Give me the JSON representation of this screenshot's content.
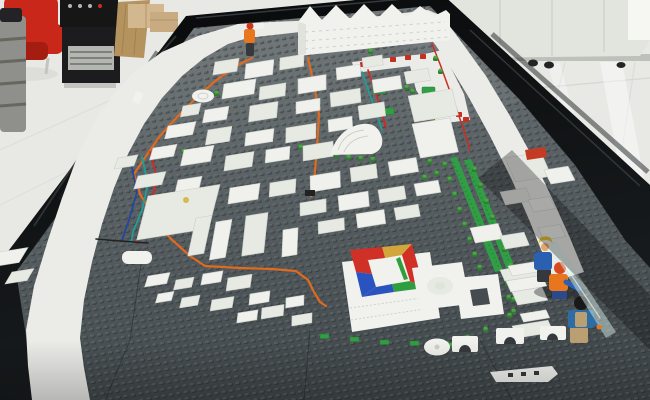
{
  "scene": {
    "type": "photograph",
    "subject": "lego-city-architectural-model-on-black-table"
  },
  "palette": {
    "floor": "#e8e9e5",
    "floorSeam": "#d5d7d1",
    "gloss": "#ffffff",
    "cabinet": "#e2e4de",
    "cabinetSeam": "#c6cac2",
    "cabinetShadow": "#b2b6ae",
    "brightPanel": "#f6f7f3",
    "chairRed": "#c8271a",
    "chairRedDark": "#a51d10",
    "grayStack": "#8f8f8b",
    "grayStripe": "#67675f",
    "darkCap": "#232325",
    "ampBlack": "#161616",
    "boxBlack": "#1c1c1e",
    "grille": "#b4b6b2",
    "grilleSlot": "#4a4c48",
    "metal": "#c2c4c0",
    "wood": "#b5935f",
    "woodGrain": "#997a49",
    "cardboard": "#d3b78e",
    "cardboardDark": "#c8ab80",
    "cardboardEdge": "#b0946a",
    "rim": "#0b0d0e",
    "rimGloss": "#343a3c",
    "rimGloss2": "#1d2224",
    "baseFar": "#7b8181",
    "baseNear": "#454b4e",
    "seam": "#262b2e",
    "road": "#ebece8",
    "roadEdge": "#d9dbd4",
    "building": "#f0f1ed",
    "buildingAlt": "#e7e9e3",
    "buildingEdge": "#cdd1ca",
    "buildingShade": "#e0e2dc",
    "green": "#4aa840",
    "greenDark": "#2e7d32",
    "greenStrip": "#2f9e44",
    "red": "#c62f22",
    "yellowDot": "#d8b84a",
    "wireOrange": "#e06a1e",
    "wireRed": "#cf2b20",
    "wireTeal": "#1f9e96",
    "wireBlue": "#23479e",
    "wireDark": "#222222",
    "ringRed": "#d03026",
    "ringYellow": "#d2a63a",
    "ringBlue": "#2b53c0",
    "ringGreen": "#2f9e3f",
    "figOrange": "#e8761e",
    "figOrangeRed": "#d84a1e",
    "figBlue": "#2b5fb0",
    "figNavy": "#2b4a8e",
    "figJacket": "#2e6da4",
    "figTan": "#b99f72",
    "figDark": "#35393d",
    "figYellow": "#e6c22e",
    "figSkin": "#e0a86a",
    "hairBlack": "#191919",
    "helmetRed": "#c23b22",
    "glass": "#d4ece6",
    "glassEdge": "#eaf6f2",
    "white": "#f1f2ee",
    "shadow": "#05080a"
  },
  "city": {
    "buildings": [
      [
        215,
        62,
        24,
        13
      ],
      [
        246,
        64,
        28,
        15
      ],
      [
        280,
        58,
        24,
        12
      ],
      [
        336,
        68,
        24,
        12
      ],
      [
        362,
        58,
        20,
        10
      ],
      [
        372,
        80,
        28,
        13
      ],
      [
        404,
        72,
        24,
        12
      ],
      [
        224,
        84,
        32,
        15
      ],
      [
        260,
        87,
        26,
        13
      ],
      [
        298,
        79,
        28,
        15
      ],
      [
        330,
        93,
        30,
        14
      ],
      [
        296,
        102,
        24,
        12
      ],
      [
        250,
        106,
        28,
        16
      ],
      [
        205,
        110,
        24,
        13
      ],
      [
        183,
        106,
        18,
        11
      ],
      [
        168,
        126,
        28,
        13
      ],
      [
        208,
        130,
        24,
        15
      ],
      [
        246,
        133,
        28,
        13
      ],
      [
        286,
        128,
        30,
        15
      ],
      [
        328,
        120,
        24,
        12
      ],
      [
        358,
        106,
        26,
        14
      ],
      [
        153,
        148,
        24,
        12
      ],
      [
        118,
        158,
        20,
        11
      ],
      [
        184,
        150,
        30,
        16
      ],
      [
        226,
        156,
        28,
        15
      ],
      [
        266,
        150,
        24,
        13
      ],
      [
        303,
        146,
        30,
        15
      ],
      [
        346,
        138,
        26,
        13
      ],
      [
        138,
        176,
        28,
        13
      ],
      [
        178,
        180,
        24,
        12
      ],
      [
        148,
        196,
        72,
        44
      ],
      [
        230,
        188,
        30,
        16
      ],
      [
        270,
        183,
        26,
        14
      ],
      [
        310,
        176,
        30,
        16
      ],
      [
        350,
        168,
        26,
        14
      ],
      [
        388,
        162,
        28,
        14
      ],
      [
        300,
        203,
        26,
        13
      ],
      [
        338,
        196,
        30,
        15
      ],
      [
        378,
        190,
        26,
        13
      ],
      [
        414,
        184,
        24,
        12
      ],
      [
        408,
        96,
        44,
        26
      ],
      [
        412,
        124,
        38,
        34
      ],
      [
        505,
        158,
        36,
        24
      ],
      [
        544,
        170,
        24,
        14
      ],
      [
        500,
        192,
        26,
        13
      ],
      [
        528,
        200,
        22,
        12
      ],
      [
        196,
        218,
        16,
        38
      ],
      [
        216,
        222,
        16,
        38
      ],
      [
        246,
        216,
        22,
        40
      ],
      [
        283,
        230,
        15,
        27
      ],
      [
        318,
        222,
        26,
        12
      ],
      [
        356,
        214,
        28,
        14
      ],
      [
        394,
        208,
        24,
        12
      ],
      [
        470,
        228,
        28,
        15
      ],
      [
        500,
        236,
        24,
        13
      ],
      [
        538,
        228,
        22,
        12
      ],
      [
        500,
        270,
        44,
        11
      ],
      [
        506,
        281,
        36,
        11
      ],
      [
        512,
        292,
        30,
        13
      ],
      [
        0,
        252,
        28,
        15
      ],
      [
        12,
        272,
        22,
        12
      ],
      [
        148,
        276,
        22,
        11
      ],
      [
        176,
        280,
        18,
        10
      ],
      [
        203,
        274,
        20,
        11
      ],
      [
        228,
        278,
        24,
        13
      ],
      [
        250,
        294,
        20,
        11
      ],
      [
        182,
        298,
        18,
        10
      ],
      [
        158,
        294,
        16,
        9
      ],
      [
        212,
        300,
        22,
        11
      ],
      [
        238,
        313,
        20,
        10
      ],
      [
        262,
        308,
        22,
        11
      ],
      [
        286,
        298,
        18,
        10
      ],
      [
        292,
        316,
        20,
        10
      ],
      [
        508,
        266,
        30,
        10
      ],
      [
        512,
        326,
        36,
        12
      ],
      [
        520,
        314,
        26,
        8
      ]
    ],
    "trees": [
      [
        298,
        146
      ],
      [
        310,
        149
      ],
      [
        322,
        152
      ],
      [
        334,
        154
      ],
      [
        346,
        156
      ],
      [
        358,
        157
      ],
      [
        370,
        158
      ],
      [
        181,
        150
      ],
      [
        191,
        153
      ],
      [
        201,
        156
      ],
      [
        214,
        92
      ],
      [
        223,
        95
      ],
      [
        316,
        42
      ],
      [
        330,
        44
      ],
      [
        368,
        50
      ],
      [
        404,
        86
      ],
      [
        410,
        90
      ],
      [
        433,
        57
      ],
      [
        438,
        70
      ],
      [
        424,
        104
      ],
      [
        430,
        118
      ],
      [
        425,
        132
      ],
      [
        432,
        146
      ],
      [
        427,
        160
      ],
      [
        434,
        172
      ],
      [
        422,
        176
      ],
      [
        428,
        188
      ],
      [
        442,
        163
      ],
      [
        447,
        178
      ],
      [
        452,
        193
      ],
      [
        457,
        208
      ],
      [
        462,
        223
      ],
      [
        467,
        238
      ],
      [
        472,
        253
      ],
      [
        477,
        266
      ],
      [
        472,
        168
      ],
      [
        478,
        184
      ],
      [
        484,
        200
      ],
      [
        490,
        216
      ],
      [
        496,
        232
      ],
      [
        502,
        248
      ],
      [
        508,
        264
      ],
      [
        505,
        282
      ],
      [
        511,
        298
      ],
      [
        507,
        314
      ],
      [
        465,
        336
      ],
      [
        483,
        328
      ],
      [
        448,
        344
      ],
      [
        430,
        350
      ],
      [
        506,
        296
      ],
      [
        511,
        310
      ]
    ],
    "tiles": [
      [
        320,
        334
      ],
      [
        350,
        337
      ],
      [
        380,
        340
      ],
      [
        410,
        341
      ],
      [
        440,
        341
      ],
      [
        466,
        339
      ]
    ],
    "plates": [
      [
        373,
        87
      ],
      [
        381,
        108
      ],
      [
        422,
        87
      ],
      [
        430,
        108
      ]
    ],
    "reds": [
      [
        431,
        120
      ],
      [
        360,
        62
      ],
      [
        374,
        59
      ],
      [
        390,
        57
      ],
      [
        405,
        55
      ],
      [
        420,
        54
      ],
      [
        456,
        112
      ],
      [
        463,
        117
      ]
    ],
    "wires": [
      {
        "color": "wireOrange",
        "w": 2.2,
        "pts": [
          [
            252,
            58
          ],
          [
            236,
            66
          ],
          [
            214,
            82
          ],
          [
            196,
            98
          ],
          [
            178,
            116
          ],
          [
            160,
            136
          ],
          [
            146,
            156
          ],
          [
            134,
            174
          ],
          [
            140,
            194
          ],
          [
            154,
            216
          ],
          [
            170,
            238
          ],
          [
            190,
            256
          ],
          [
            205,
            266
          ],
          [
            240,
            268
          ],
          [
            272,
            269
          ],
          [
            296,
            271
          ],
          [
            308,
            280
          ],
          [
            314,
            292
          ],
          [
            320,
            302
          ],
          [
            326,
            306
          ]
        ]
      },
      {
        "color": "wireOrange",
        "w": 2.2,
        "pts": [
          [
            308,
            58
          ],
          [
            314,
            84
          ],
          [
            319,
            114
          ],
          [
            317,
            148
          ],
          [
            314,
            182
          ],
          [
            311,
            196
          ]
        ]
      },
      {
        "color": "wireRed",
        "w": 1.7,
        "pts": [
          [
            368,
            70
          ],
          [
            375,
            90
          ],
          [
            381,
            110
          ],
          [
            386,
            128
          ]
        ]
      },
      {
        "color": "wireTeal",
        "w": 1.7,
        "pts": [
          [
            362,
            72
          ],
          [
            369,
            92
          ],
          [
            376,
            112
          ],
          [
            382,
            130
          ]
        ]
      },
      {
        "color": "wireRed",
        "w": 1.8,
        "pts": [
          [
            150,
            152
          ],
          [
            157,
            178
          ],
          [
            151,
            205
          ],
          [
            141,
            228
          ],
          [
            137,
            241
          ]
        ]
      },
      {
        "color": "wireTeal",
        "w": 1.8,
        "pts": [
          [
            142,
            157
          ],
          [
            148,
            184
          ],
          [
            142,
            210
          ],
          [
            133,
            232
          ],
          [
            131,
            243
          ]
        ]
      },
      {
        "color": "wireBlue",
        "w": 1.8,
        "pts": [
          [
            131,
            163
          ],
          [
            137,
            192
          ],
          [
            129,
            220
          ],
          [
            122,
            240
          ]
        ]
      },
      {
        "color": "wireDark",
        "w": 1.6,
        "pts": [
          [
            148,
            243
          ],
          [
            120,
            241
          ],
          [
            96,
            239
          ]
        ]
      },
      {
        "color": "wireRed",
        "w": 1.5,
        "pts": [
          [
            432,
            44
          ],
          [
            440,
            64
          ],
          [
            448,
            86
          ],
          [
            456,
            108
          ],
          [
            464,
            130
          ],
          [
            470,
            150
          ]
        ]
      }
    ]
  }
}
